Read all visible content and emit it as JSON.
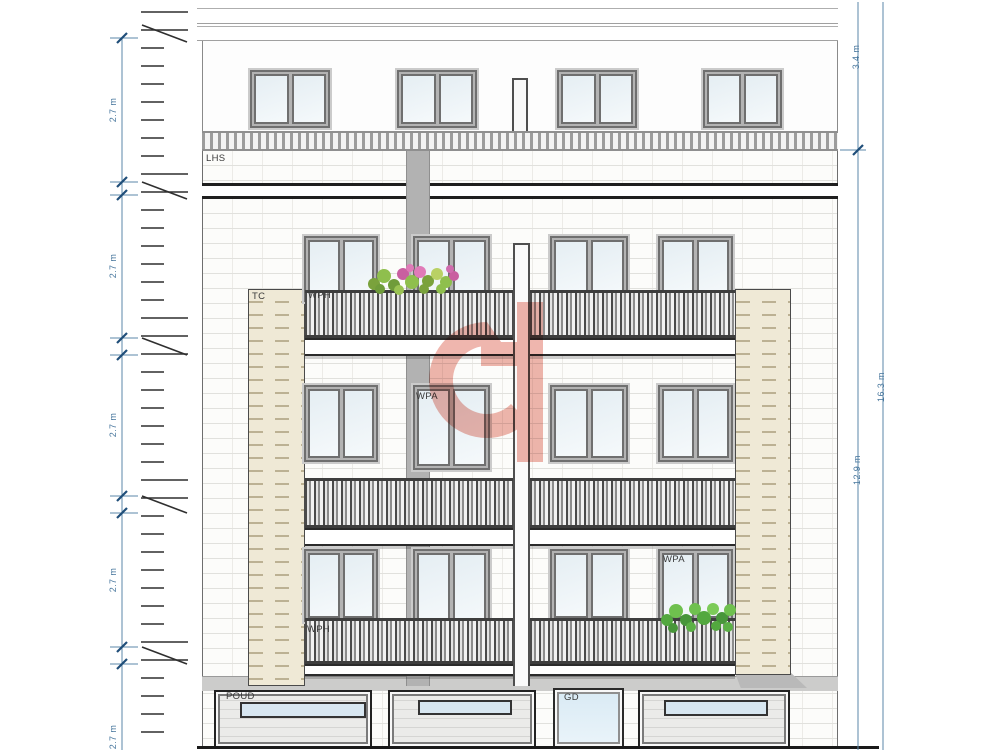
{
  "drawing": {
    "title": "Front elevation drawing",
    "room_tags": {
      "lhs": "LHS",
      "tc": "TC",
      "wph_top": "WPH",
      "wpa_mid": "WPA",
      "wpa_lower_right": "WPA",
      "wph_lower": "WPH",
      "poud": "POUD",
      "gd": "GD"
    },
    "dimensions": {
      "left_floor_heights": [
        "2.7 m",
        "2.7 m",
        "2.7 m",
        "2.7 m",
        "2.7 m"
      ],
      "right_top": "3.4 m",
      "right_main": "12.9 m",
      "right_total": "16.3 m"
    },
    "colors": {
      "dimension_blue": "#5b87a8",
      "tick_blue": "#1f4e79",
      "cream_brick": "#efe9d6",
      "watermark_red": "#e2796b",
      "glass_blue": "#e5eef3",
      "railing_dark": "#3e3e3e"
    }
  }
}
